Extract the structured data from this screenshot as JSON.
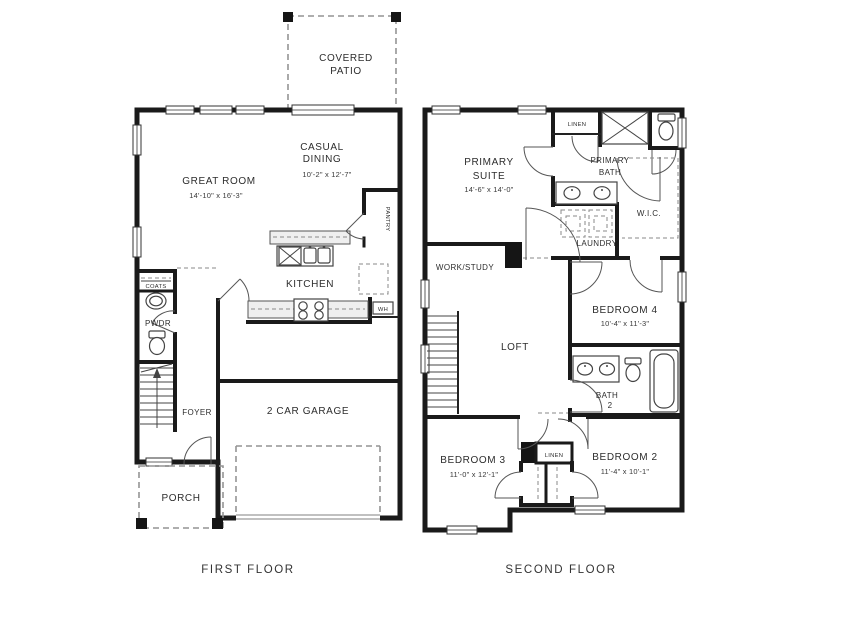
{
  "captions": {
    "first_floor": "FIRST FLOOR",
    "second_floor": "SECOND FLOOR"
  },
  "first_floor": {
    "rooms": {
      "covered_patio": {
        "lines": [
          "COVERED",
          "PATIO"
        ]
      },
      "casual_dining": {
        "lines": [
          "CASUAL",
          "DINING"
        ],
        "dims": "10'-2\" x 12'-7\""
      },
      "great_room": {
        "lines": [
          "GREAT ROOM"
        ],
        "dims": "14'-10\" x 16'-3\""
      },
      "kitchen": {
        "lines": [
          "KITCHEN"
        ]
      },
      "pantry": {
        "lines": [
          "PANTRY"
        ]
      },
      "coats": {
        "lines": [
          "COATS"
        ]
      },
      "powder": {
        "lines": [
          "PWDR"
        ]
      },
      "water_heater": {
        "lines": [
          "WH"
        ]
      },
      "foyer": {
        "lines": [
          "FOYER"
        ]
      },
      "garage": {
        "lines": [
          "2 CAR GARAGE"
        ]
      },
      "porch": {
        "lines": [
          "PORCH"
        ]
      }
    }
  },
  "second_floor": {
    "rooms": {
      "primary_suite": {
        "lines": [
          "PRIMARY",
          "SUITE"
        ],
        "dims": "14'-6\" x 14'-0\""
      },
      "linen_upper": {
        "lines": [
          "LINEN"
        ]
      },
      "primary_bath": {
        "lines": [
          "PRIMARY",
          "BATH"
        ]
      },
      "wic": {
        "lines": [
          "W.I.C."
        ]
      },
      "laundry": {
        "lines": [
          "LAUNDRY"
        ]
      },
      "work_study": {
        "lines": [
          "WORK/STUDY"
        ]
      },
      "loft": {
        "lines": [
          "LOFT"
        ]
      },
      "bedroom4": {
        "lines": [
          "BEDROOM 4"
        ],
        "dims": "10'-4\" x 11'-3\""
      },
      "bath2": {
        "lines": [
          "BATH",
          "2"
        ]
      },
      "bedroom3": {
        "lines": [
          "BEDROOM 3"
        ],
        "dims": "11'-0\" x 12'-1\""
      },
      "linen_lower": {
        "lines": [
          "LINEN"
        ]
      },
      "bedroom2": {
        "lines": [
          "BEDROOM 2"
        ],
        "dims": "11'-4\" x 10'-1\""
      }
    }
  },
  "colors": {
    "wall": "#1a1a1a",
    "fixture": "#555555",
    "dashed": "#949494",
    "text": "#2d2d2d",
    "background": "#ffffff"
  }
}
